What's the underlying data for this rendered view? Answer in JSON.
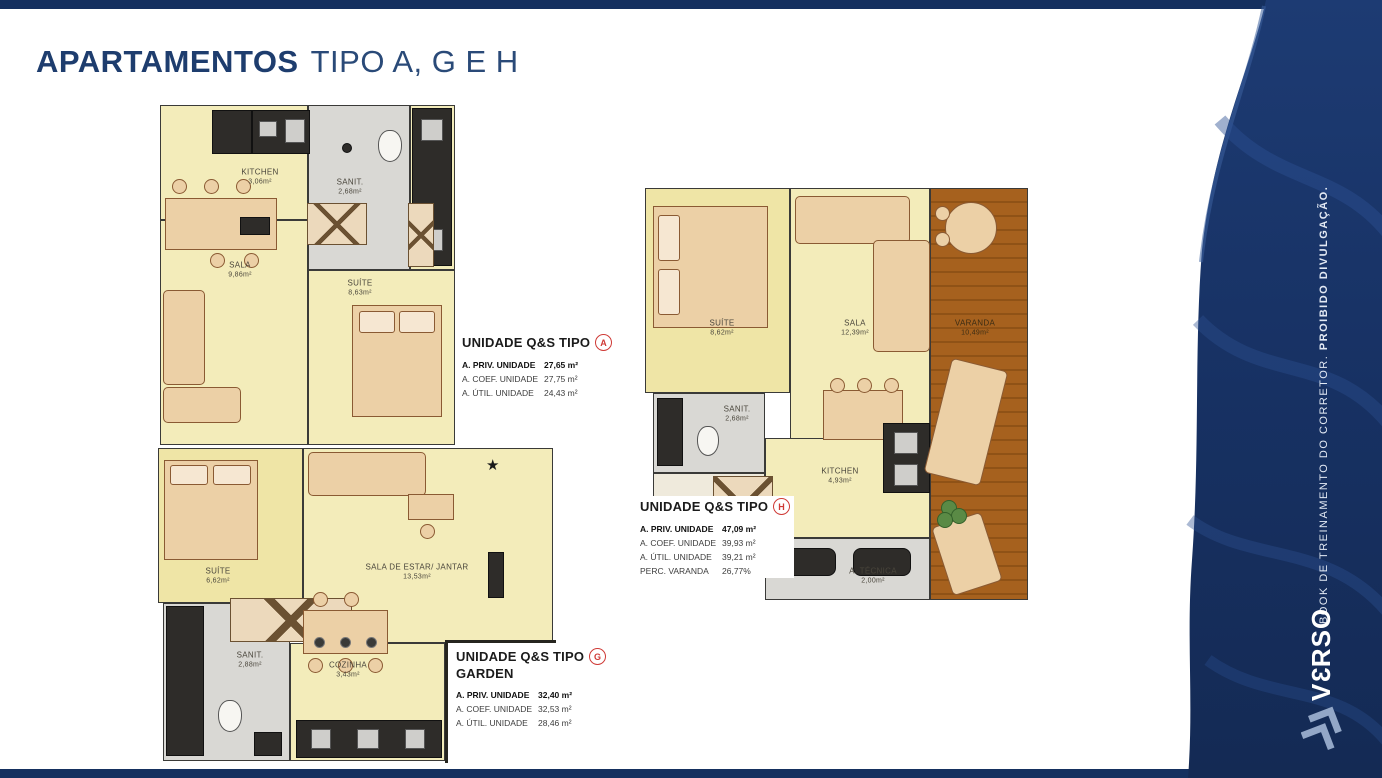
{
  "header": {
    "title_bold": "APARTAMENTOS",
    "title_light": "TIPO A, G E H"
  },
  "plans": {
    "a": {
      "rooms": [
        {
          "name": "KITCHEN",
          "area": "3,06m²"
        },
        {
          "name": "SANIT.",
          "area": "2,68m²"
        },
        {
          "name": "SALA",
          "area": "9,86m²"
        },
        {
          "name": "SUÍTE",
          "area": "8,63m²"
        }
      ]
    },
    "h": {
      "rooms": [
        {
          "name": "SUÍTE",
          "area": "8,62m²"
        },
        {
          "name": "SALA",
          "area": "12,39m²"
        },
        {
          "name": "VARANDA",
          "area": "10,49m²"
        },
        {
          "name": "SANIT.",
          "area": "2,68m²"
        },
        {
          "name": "KITCHEN",
          "area": "4,93m²"
        },
        {
          "name": "A. TÉCNICA",
          "area": "2,00m²"
        }
      ]
    },
    "g": {
      "rooms": [
        {
          "name": "SUÍTE",
          "area": "6,62m²"
        },
        {
          "name": "SALA DE ESTAR/ JANTAR",
          "area": "13,53m²"
        },
        {
          "name": "SANIT.",
          "area": "2,88m²"
        },
        {
          "name": "COZINHA",
          "area": "3,43m²"
        }
      ]
    }
  },
  "units": [
    {
      "title": "UNIDADE Q&S TIPO",
      "badge": "A",
      "rows": [
        {
          "label": "A. PRIV. UNIDADE",
          "value": "27,65 m²"
        },
        {
          "label": "A. COEF. UNIDADE",
          "value": "27,75 m²"
        },
        {
          "label": "A. ÚTIL. UNIDADE",
          "value": "24,43 m²"
        }
      ]
    },
    {
      "title": "UNIDADE Q&S TIPO",
      "badge": "H",
      "rows": [
        {
          "label": "A. PRIV. UNIDADE",
          "value": "47,09 m²"
        },
        {
          "label": "A. COEF. UNIDADE",
          "value": "39,93 m²"
        },
        {
          "label": "A. ÚTIL. UNIDADE",
          "value": "39,21 m²"
        },
        {
          "label": "PERC. VARANDA",
          "value": "26,77%"
        }
      ]
    },
    {
      "title": "UNIDADE Q&S TIPO",
      "badge": "G",
      "subtitle": "GARDEN",
      "rows": [
        {
          "label": "A. PRIV. UNIDADE",
          "value": "32,40 m²"
        },
        {
          "label": "A. COEF. UNIDADE",
          "value": "32,53 m²"
        },
        {
          "label": "A. ÚTIL. UNIDADE",
          "value": "28,46 m²"
        }
      ]
    }
  ],
  "sidebar": {
    "watermark_regular": "BOOK DE TREINAMENTO DO CORRETOR. ",
    "watermark_bold": "PROIBIDO DIVULGAÇÃO.",
    "logo_prefix": "V",
    "logo_mirrored": "3",
    "logo_suffix": "RSO"
  },
  "colors": {
    "navy": "#15305f",
    "red_badge": "#cf3a36",
    "room_yellow": "#f3ecba",
    "bath_gray": "#d9d8d4",
    "wood_brown": "#a6611e"
  }
}
